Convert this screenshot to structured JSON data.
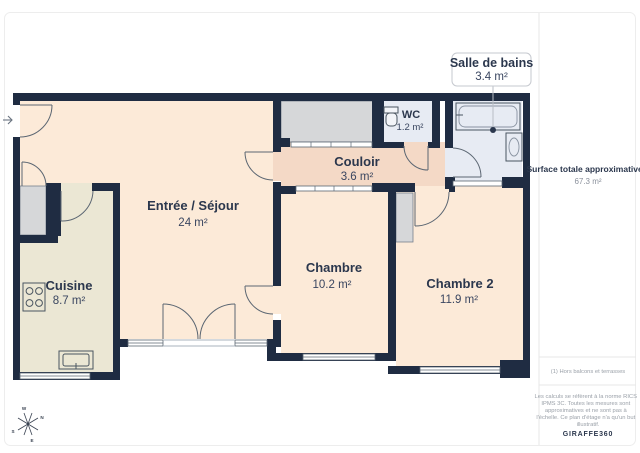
{
  "rooms": {
    "entree": {
      "name": "Entrée / Séjour",
      "area": "24 m²"
    },
    "cuisine": {
      "name": "Cuisine",
      "area": "8.7 m²"
    },
    "couloir": {
      "name": "Couloir",
      "area": "3.6 m²"
    },
    "wc": {
      "name": "WC",
      "area": "1.2 m²"
    },
    "salle_de_bains": {
      "name": "Salle de bains",
      "area": "3.4 m²"
    },
    "chambre": {
      "name": "Chambre",
      "area": "10.2 m²"
    },
    "chambre2": {
      "name": "Chambre 2",
      "area": "11.9 m²"
    }
  },
  "sidebar": {
    "surface_label": "Surface totale approximative",
    "surface_sup": "(1)",
    "surface_value": "67.3 m²",
    "footnote": "(1) Hors balcons et terrasses",
    "disclaimer_lines": [
      "Les calculs se réfèrent à la norme RICS",
      "IPMS 3C. Toutes les mesures sont",
      "approximatives et ne sont pas à",
      "l'échelle. Ce plan d'étage n'a qu'un but",
      "illustratif."
    ],
    "brand": "GIRAFFE360"
  },
  "compass": {
    "n": "N",
    "e": "E",
    "s": "S",
    "w": "W"
  },
  "colors": {
    "wall": "#1f2c42",
    "room_peach": "#fcead8",
    "corridor_salmon": "#f4d9c6",
    "kitchen_cream": "#ebe7d4",
    "wet_room_blue": "#e7ebf3",
    "fixture_gray": "#d6d7d9",
    "text_dark": "#2b374d",
    "text_muted": "#9aa0a8"
  }
}
